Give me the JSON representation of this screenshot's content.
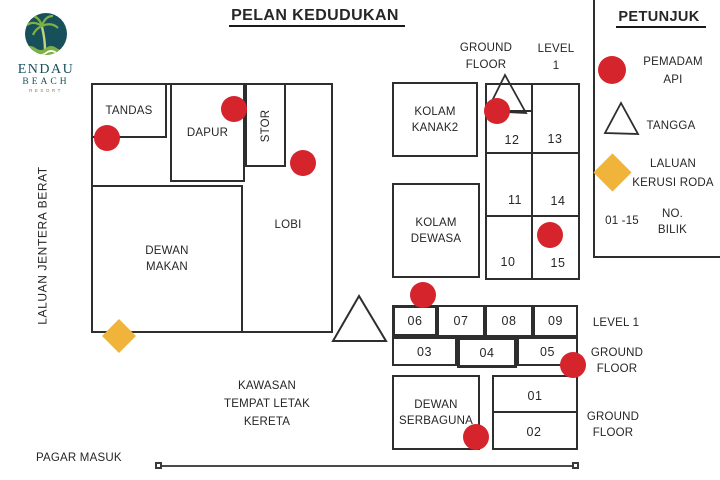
{
  "title": "PELAN KEDUDUKAN",
  "logo": {
    "name": "ENDAU",
    "sub": "BEACH",
    "tagline": "RESORT"
  },
  "side": {
    "heavy_machinery_lane": "LALUAN JENTERA BERAT",
    "entrance_gate": "PAGAR MASUK"
  },
  "parking": [
    "KAWASAN",
    "TEMPAT LETAK",
    "KERETA"
  ],
  "building": {
    "tandas": "TANDAS",
    "dapur": "DAPUR",
    "stor": "STOR",
    "lobi": "LOBI",
    "dewan_makan": [
      "DEWAN",
      "MAKAN"
    ]
  },
  "pools": {
    "kanak": [
      "KOLAM",
      "KANAK2"
    ],
    "dewasa": [
      "KOLAM",
      "DEWASA"
    ]
  },
  "serbaguna": [
    "DEWAN",
    "SERBAGUNA"
  ],
  "floors": {
    "top_ground": [
      "GROUND",
      "FLOOR"
    ],
    "top_level": [
      "LEVEL",
      "1"
    ],
    "mid_level": "LEVEL 1",
    "mid_ground": [
      "GROUND",
      "FLOOR"
    ],
    "bottom_ground": [
      "GROUND",
      "FLOOR"
    ]
  },
  "rooms": {
    "r01": "01",
    "r02": "02",
    "r03": "03",
    "r04": "04",
    "r05": "05",
    "r06": "06",
    "r07": "07",
    "r08": "08",
    "r09": "09",
    "r10": "10",
    "r11": "11",
    "r12": "12",
    "r13": "13",
    "r14": "14",
    "r15": "15"
  },
  "legend": {
    "title": "PETUNJUK",
    "fire_extinguisher": [
      "PEMADAM",
      "API"
    ],
    "stairs": "TANGGA",
    "wheelchair": [
      "LALUAN",
      "KERUSI RODA"
    ],
    "room_range": "01 -15",
    "room_label": [
      "NO.",
      "BILIK"
    ]
  },
  "colors": {
    "red": "#d5242c",
    "yellow": "#f0b43a",
    "teal": "#17505b",
    "wall": "#2e2e2e"
  }
}
